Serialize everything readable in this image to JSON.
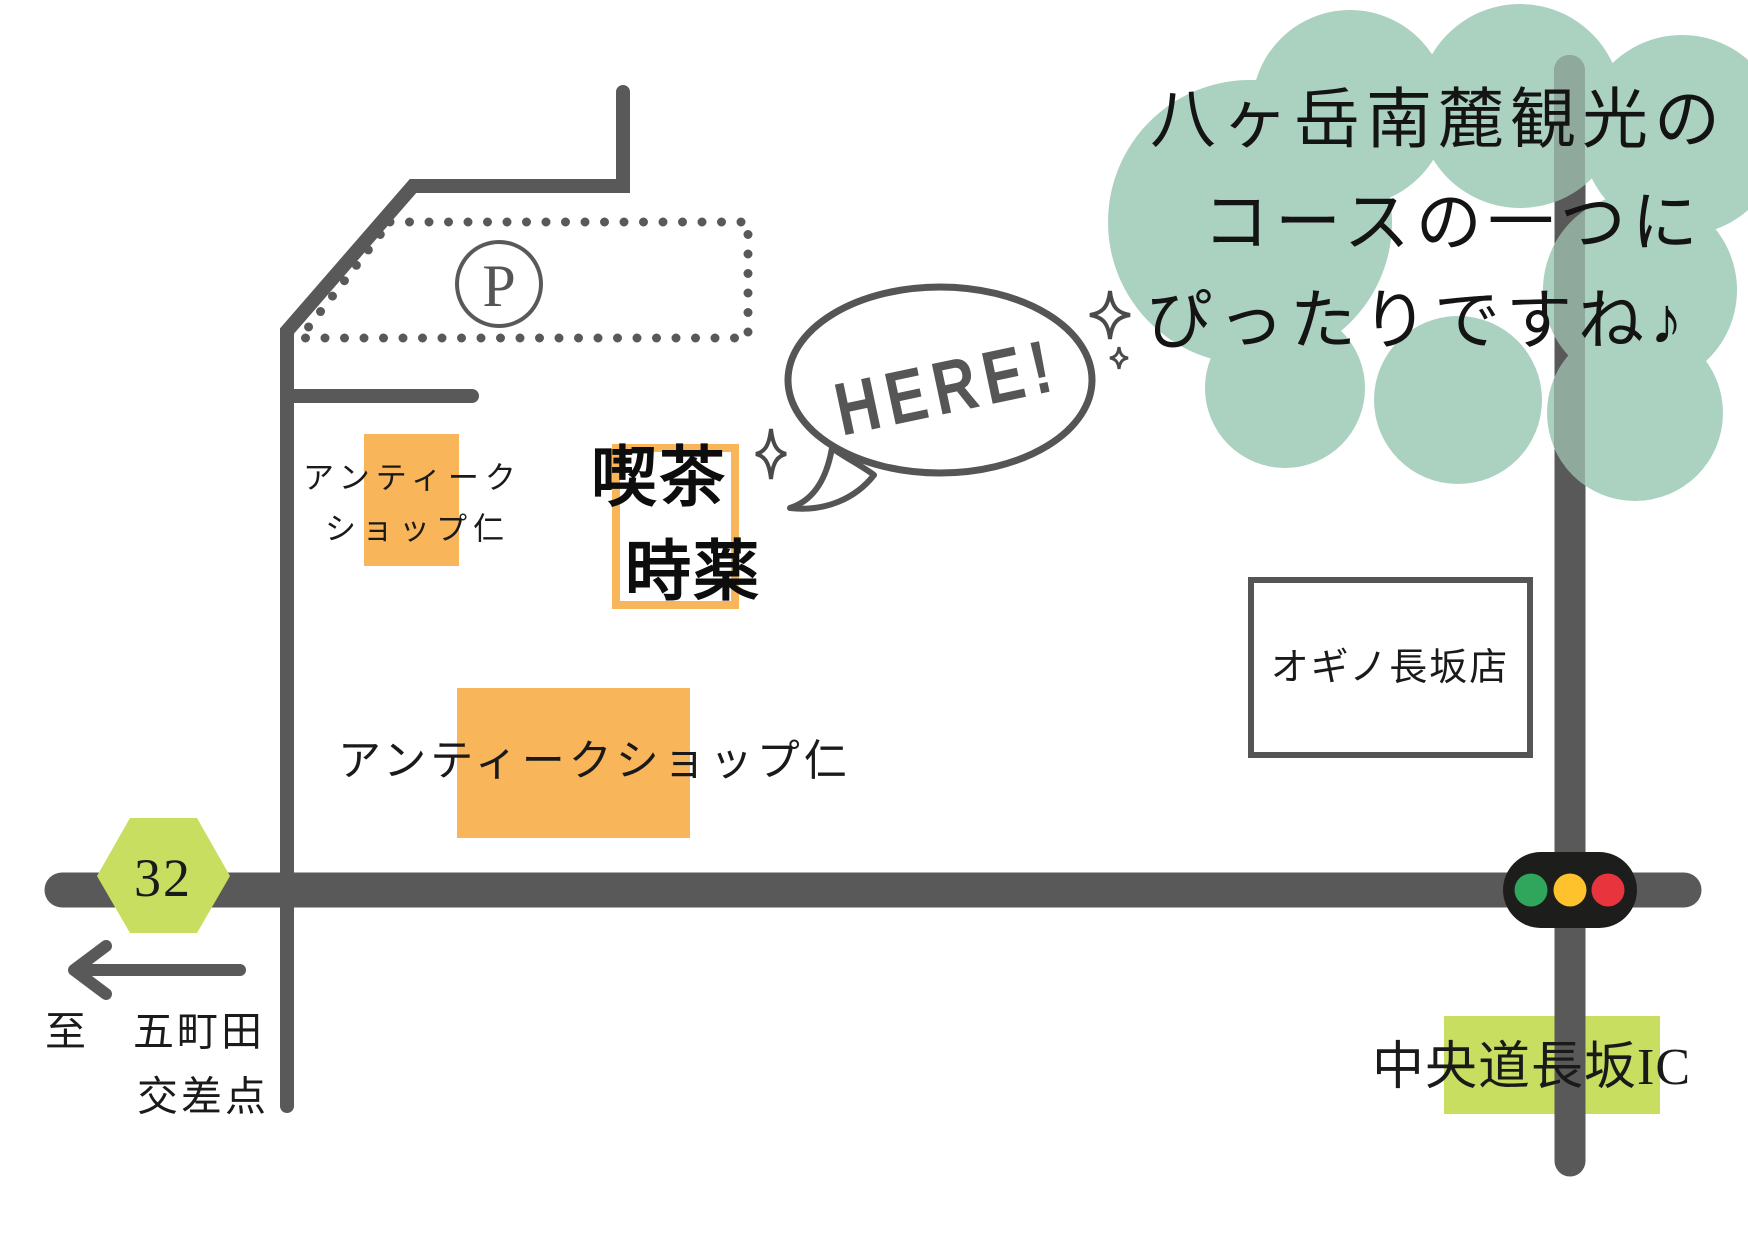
{
  "colors": {
    "road_gray": "#595959",
    "outline_gray": "#555555",
    "orange": "#F9B55A",
    "cloud_green": "#ABD1C0",
    "road_through_cloud": "#8FA99C",
    "yellow_green": "#C7DE61",
    "traffic_body": "#1D1D1B",
    "traffic_green": "#2FA65C",
    "traffic_amber": "#FDC22C",
    "traffic_red": "#E8343C",
    "text_black": "#1A1A1A"
  },
  "cloud_note": {
    "line1": "八ヶ岳南麓観光の",
    "line2": "コースの一つに",
    "line3": "ぴったりですね♪"
  },
  "speech_bubble": {
    "text": "HERE!"
  },
  "parking": {
    "symbol": "P"
  },
  "cafe": {
    "name_line1": "喫茶",
    "name_line2": "時薬"
  },
  "antique_shop_small": {
    "name_line1": "アンティーク",
    "name_line2": "ショップ仁"
  },
  "antique_shop_large": {
    "name": "アンティークショップ仁"
  },
  "supermarket": {
    "name": "オギノ長坂店"
  },
  "route_badge": {
    "number": "32"
  },
  "direction_sign": {
    "line1": "至　五町田",
    "line2": "交差点"
  },
  "interchange": {
    "name": "中央道長坂IC"
  }
}
